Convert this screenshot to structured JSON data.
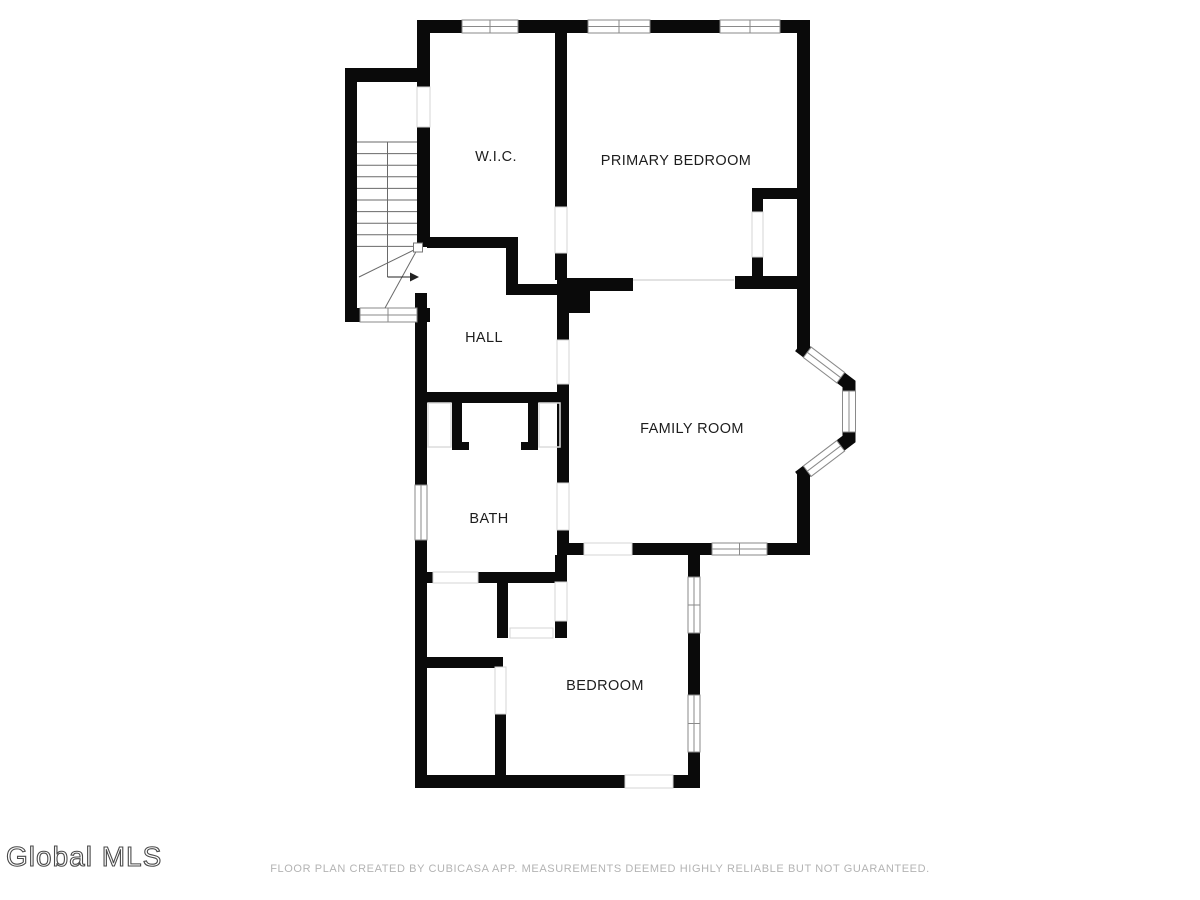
{
  "page": {
    "background_color": "#ffffff"
  },
  "floorplan": {
    "wall_color": "#0a0a0a",
    "window_frame_color": "#8a8a8a",
    "door_line_color": "#d4d4d4",
    "rooms": [
      {
        "id": "wic",
        "label": "W.I.C."
      },
      {
        "id": "primary-bedroom",
        "label": "PRIMARY BEDROOM"
      },
      {
        "id": "hall",
        "label": "HALL"
      },
      {
        "id": "family-room",
        "label": "FAMILY ROOM"
      },
      {
        "id": "bath",
        "label": "BATH"
      },
      {
        "id": "bedroom",
        "label": "BEDROOM"
      }
    ],
    "stairs": {
      "direction_arrow": "right"
    }
  },
  "watermark": {
    "text": "Global MLS"
  },
  "footer": {
    "disclaimer": "FLOOR PLAN CREATED BY CUBICASA APP. MEASUREMENTS DEEMED HIGHLY RELIABLE BUT NOT GUARANTEED."
  }
}
